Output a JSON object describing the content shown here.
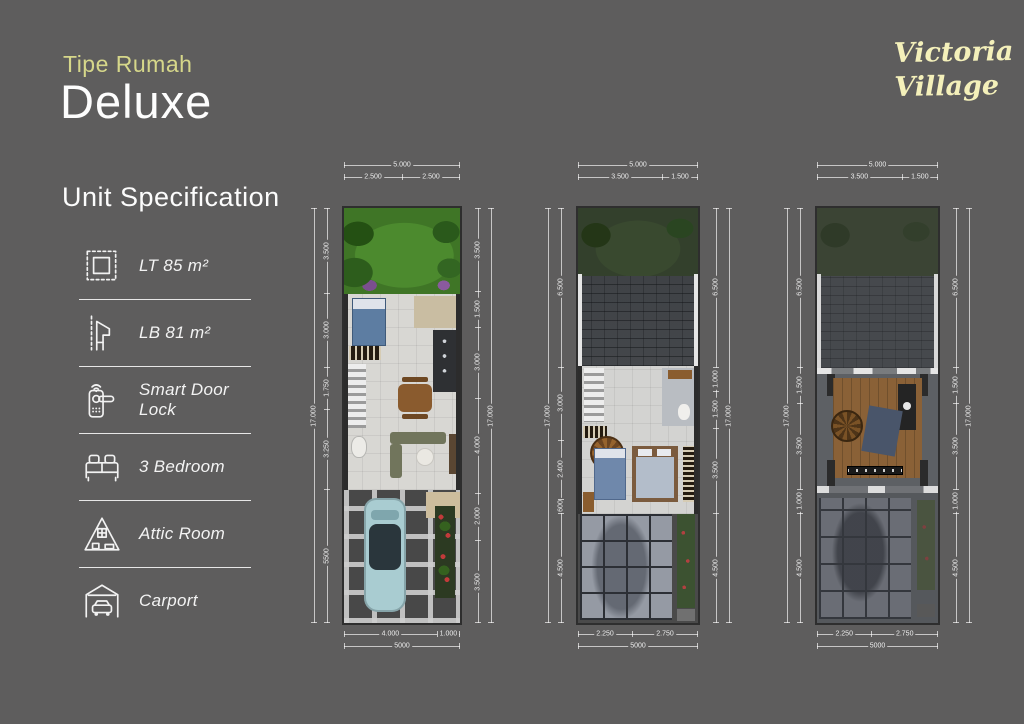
{
  "header": {
    "eyebrow": "Tipe Rumah",
    "title": "Deluxe"
  },
  "brand": {
    "line1": "Victoria",
    "line2": "Village"
  },
  "sidebar": {
    "heading": "Unit Specification",
    "items": [
      {
        "icon": "land-area-icon",
        "label": "LT 85 m²"
      },
      {
        "icon": "building-area-icon",
        "label": "LB 81 m²"
      },
      {
        "icon": "smart-door-lock-icon",
        "label": "Smart Door Lock"
      },
      {
        "icon": "bed-icon",
        "label": "3 Bedroom"
      },
      {
        "icon": "attic-icon",
        "label": "Attic Room"
      },
      {
        "icon": "carport-icon",
        "label": "Carport"
      }
    ]
  },
  "colors": {
    "background": "#5e5d5d",
    "accent_yellow": "#d6d78a",
    "brand_yellow": "#f4f0ba",
    "text": "#f5f5f5"
  },
  "plans": [
    {
      "id": "ground-floor",
      "dims": {
        "top_total": "5.000",
        "top_segments": [
          {
            "label": "2.500",
            "size": 2.5
          },
          {
            "label": "2.500",
            "size": 2.5
          }
        ],
        "bottom_segments": [
          {
            "label": "4.000",
            "size": 4
          },
          {
            "label": "1.000",
            "size": 1
          }
        ],
        "bottom_total": "5000",
        "left_total": "17.000",
        "left_segments": [
          {
            "label": "3.500",
            "size": 3.5
          },
          {
            "label": "3.000",
            "size": 3
          },
          {
            "label": "1.750",
            "size": 1.75
          },
          {
            "label": "3.250",
            "size": 3.25
          },
          {
            "label": "5500",
            "size": 5.5
          }
        ],
        "right_segments": [
          {
            "label": "3.500",
            "size": 3.5
          },
          {
            "label": "1.500",
            "size": 1.5
          },
          {
            "label": "3.000",
            "size": 3
          },
          {
            "label": "4.000",
            "size": 4
          },
          {
            "label": "2.000",
            "size": 2
          },
          {
            "label": "3.500",
            "size": 3.5
          }
        ],
        "right_total": "17.000"
      }
    },
    {
      "id": "second-floor",
      "dims": {
        "top_total": "5.000",
        "top_segments": [
          {
            "label": "3.500",
            "size": 3.5
          },
          {
            "label": "1.500",
            "size": 1.5
          }
        ],
        "bottom_segments": [
          {
            "label": "2.250",
            "size": 2.25
          },
          {
            "label": "2.750",
            "size": 2.75
          }
        ],
        "bottom_total": "5000",
        "left_total": "17.000",
        "left_segments": [
          {
            "label": "6.500",
            "size": 6.5
          },
          {
            "label": "3.000",
            "size": 3
          },
          {
            "label": "2.400",
            "size": 2.4
          },
          {
            "label": "600",
            "size": 0.6
          },
          {
            "label": "4.500",
            "size": 4.5
          }
        ],
        "right_segments": [
          {
            "label": "6.500",
            "size": 6.5
          },
          {
            "label": "1.000",
            "size": 1
          },
          {
            "label": "1.500",
            "size": 1.5
          },
          {
            "label": "3.500",
            "size": 3.5
          },
          {
            "label": "4.500",
            "size": 4.5
          }
        ],
        "right_total": "17.000"
      }
    },
    {
      "id": "attic-floor",
      "dims": {
        "top_total": "5.000",
        "top_segments": [
          {
            "label": "3.500",
            "size": 3.5
          },
          {
            "label": "1.500",
            "size": 1.5
          }
        ],
        "bottom_segments": [
          {
            "label": "2.250",
            "size": 2.25
          },
          {
            "label": "2.750",
            "size": 2.75
          }
        ],
        "bottom_total": "5000",
        "left_total": "17.000",
        "left_segments": [
          {
            "label": "6.500",
            "size": 6.5
          },
          {
            "label": "1.500",
            "size": 1.5
          },
          {
            "label": "3.500",
            "size": 3.5
          },
          {
            "label": "1.000",
            "size": 1
          },
          {
            "label": "4.500",
            "size": 4.5
          }
        ],
        "right_segments": [
          {
            "label": "6.500",
            "size": 6.5
          },
          {
            "label": "1.500",
            "size": 1.5
          },
          {
            "label": "3.500",
            "size": 3.5
          },
          {
            "label": "1.000",
            "size": 1
          },
          {
            "label": "4.500",
            "size": 4.5
          }
        ],
        "right_total": "17.000"
      }
    }
  ]
}
